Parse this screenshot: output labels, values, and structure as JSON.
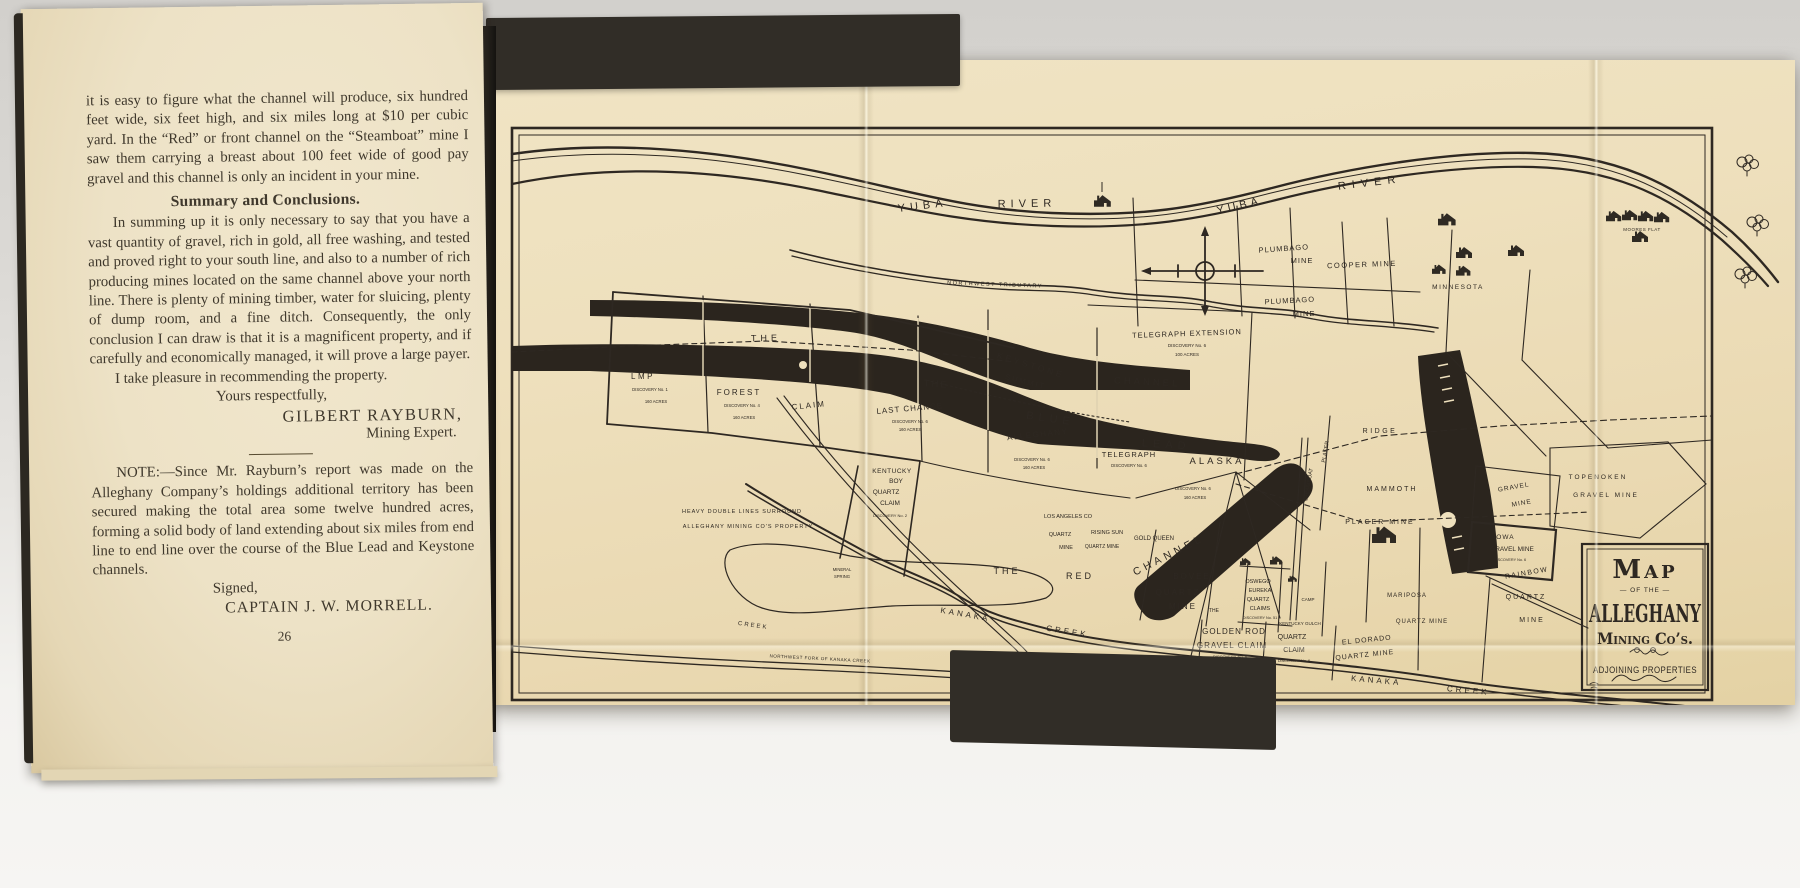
{
  "palette": {
    "backdrop": "#dcdad6",
    "cover": "#312d27",
    "page": "#ede2c6",
    "sheet": "#eee0bd",
    "ink": "#2e2822",
    "ink_light": "#efe4c3"
  },
  "left_page": {
    "body_top": "it is easy to figure what the channel will produce, six hundred feet wide, six feet high, and six miles long at $10 per cubic yard.  In the “Red” or front channel on the “Steamboat” mine I saw them carrying a breast about 100 feet wide of good pay gravel and this channel is only an incident in your mine.",
    "heading": "Summary and Conclusions.",
    "body_summary": "In summing up it is only necessary to say that you have a vast quantity of gravel, rich in gold, all free washing, and tested and proved right to your south line, and also to a number of rich producing mines located on the same channel above your north line. There is plenty of mining timber, water for sluicing, plenty of dump room, and a fine ditch.  Consequently, the only conclusion I can draw is that it is a magnificent property, and if carefully and economically managed, it will prove a large payer.",
    "recommend_line": "I take pleasure in recommending the property.",
    "valediction": "Yours respectfully,",
    "signature_name": "GILBERT RAYBURN,",
    "signature_title": "Mining Expert.",
    "note": "NOTE:—Since Mr. Rayburn’s report was made on the Alleghany Company’s holdings additional territory has been secured making the total area some twelve hundred acres, forming a solid body of land extending about six miles from end line to end line over the course of the Blue Lead and Keystone channels.",
    "signed_label": "Signed,",
    "signed_name": "CAPTAIN J. W. MORRELL.",
    "page_number": "26"
  },
  "map": {
    "ink": "#2e2822",
    "ink_light": "#efe4c3",
    "title_block": {
      "line1": "Map",
      "line2": "— OF THE —",
      "line3": "ALLEGHANY",
      "line4": "Mining Co’s.",
      "line5": "ADJOINING PROPERTIES"
    },
    "labels": [
      {
        "id": "yuba-river-1a",
        "t": "YUBA",
        "x": 433,
        "y": 149,
        "s": 11,
        "r": -7,
        "ls": 5
      },
      {
        "id": "yuba-river-1b",
        "t": "RIVER",
        "x": 537,
        "y": 147,
        "s": 11,
        "r": -1,
        "ls": 5
      },
      {
        "id": "yuba-river-2a",
        "t": "YUBA",
        "x": 750,
        "y": 149,
        "s": 11,
        "r": -13,
        "ls": 4
      },
      {
        "id": "yuba-river-2b",
        "t": "RIVER",
        "x": 880,
        "y": 126,
        "s": 11,
        "r": -7,
        "ls": 6
      },
      {
        "id": "northwest-tributary",
        "t": "NORTHWEST  TRIBUTARY",
        "x": 505,
        "y": 226,
        "s": 5.5,
        "r": 2,
        "ls": 1.5
      },
      {
        "id": "plumbago-mine-1a",
        "t": "PLUMBAGO",
        "x": 794,
        "y": 191,
        "s": 7.5,
        "r": -4,
        "ls": 1
      },
      {
        "id": "plumbago-mine-1b",
        "t": "MINE",
        "x": 812,
        "y": 203,
        "s": 7.5,
        "ls": 1
      },
      {
        "id": "cooper-mine",
        "t": "COOPER  MINE",
        "x": 872,
        "y": 207,
        "s": 7.5,
        "r": -2,
        "ls": 1.5
      },
      {
        "id": "plumbago-mine-2a",
        "t": "PLUMBAGO",
        "x": 800,
        "y": 243,
        "s": 7.5,
        "r": -3,
        "ls": 1
      },
      {
        "id": "plumbago-mine-2b",
        "t": "MINE",
        "x": 814,
        "y": 256,
        "s": 7.5,
        "ls": 1
      },
      {
        "id": "minnesota",
        "t": "MINNESOTA",
        "x": 968,
        "y": 229,
        "s": 6.5,
        "ls": 1.5
      },
      {
        "id": "moores-flat",
        "t": "MOORES FLAT",
        "x": 1152,
        "y": 171,
        "s": 4.5,
        "ls": 0.5
      },
      {
        "id": "telegraph-extension",
        "t": "TELEGRAPH EXTENSION",
        "x": 697,
        "y": 276,
        "s": 7.5,
        "r": -2,
        "ls": 1
      },
      {
        "id": "telegraph-extension-disc",
        "t": "DISCOVERY No. 6",
        "x": 697,
        "y": 287,
        "s": 4.5
      },
      {
        "id": "telegraph-extension-acres",
        "t": "100 ACRES",
        "x": 697,
        "y": 296,
        "s": 4.5
      },
      {
        "id": "the-dashed",
        "t": "THE",
        "x": 276,
        "y": 281,
        "s": 9,
        "r": -1,
        "ls": 4
      },
      {
        "id": "keystone",
        "t": "KEYSTONE",
        "x": 540,
        "y": 308,
        "s": 8.5,
        "r": 17,
        "ls": 3,
        "w": 1
      },
      {
        "id": "summit",
        "t": "SUMMIT",
        "x": 535,
        "y": 324,
        "s": 7.5,
        "r": 14,
        "ls": 2,
        "w": 1
      },
      {
        "id": "channel-keystone",
        "t": "CHANNEL",
        "x": 657,
        "y": 325,
        "s": 9.5,
        "r": 3,
        "ls": 3,
        "w": 1
      },
      {
        "id": "the-blue",
        "t": "THE",
        "x": 446,
        "y": 327,
        "s": 9.5,
        "r": 4,
        "ls": 2,
        "w": 1
      },
      {
        "id": "blue",
        "t": "BLUE",
        "x": 560,
        "y": 362,
        "s": 11,
        "r": 8,
        "ls": 5,
        "w": 1
      },
      {
        "id": "lead",
        "t": "LEAD",
        "x": 676,
        "y": 388,
        "s": 11,
        "r": 4,
        "ls": 5,
        "w": 1
      },
      {
        "id": "last-chance",
        "t": "LAST  CHANCE",
        "x": 420,
        "y": 351,
        "s": 8,
        "r": -5,
        "ls": 1
      },
      {
        "id": "last-chance-disc",
        "t": "DISCOVERY No. 6",
        "x": 420,
        "y": 363,
        "s": 4.2
      },
      {
        "id": "last-chance-acres",
        "t": "160 ACRES",
        "x": 420,
        "y": 371,
        "s": 4.2
      },
      {
        "id": "alleghany-claim",
        "t": "ALLEGHANY",
        "x": 548,
        "y": 377,
        "s": 8,
        "r": -6,
        "ls": 1.5
      },
      {
        "id": "alleghany-disc",
        "t": "DISCOVERY No. 6",
        "x": 542,
        "y": 401,
        "s": 4.2
      },
      {
        "id": "alleghany-acres",
        "t": "160 ACRES",
        "x": 544,
        "y": 409,
        "s": 4.2
      },
      {
        "id": "telegraph",
        "t": "TELEGRAPH",
        "x": 639,
        "y": 397,
        "s": 7.5,
        "ls": 1
      },
      {
        "id": "telegraph-disc",
        "t": "DISCOVERY No. 6",
        "x": 639,
        "y": 407,
        "s": 4.2
      },
      {
        "id": "alaska",
        "t": "ALASKA",
        "x": 727,
        "y": 404,
        "s": 9.5,
        "ls": 3
      },
      {
        "id": "alaska-disc",
        "t": "DISCOVERY No. 6",
        "x": 703,
        "y": 430,
        "s": 4.2
      },
      {
        "id": "alaska-acres",
        "t": "160 ACRES",
        "x": 705,
        "y": 439,
        "s": 4.2
      },
      {
        "id": "lmp",
        "t": "LMP",
        "x": 153,
        "y": 319,
        "s": 8,
        "ls": 2.5
      },
      {
        "id": "lmp-disc",
        "t": "DISCOVERY No. 1",
        "x": 160,
        "y": 331,
        "s": 4.2
      },
      {
        "id": "lmp-acres",
        "t": "160 ACRES",
        "x": 166,
        "y": 343,
        "s": 4.2
      },
      {
        "id": "forest",
        "t": "FOREST",
        "x": 249,
        "y": 335,
        "s": 8,
        "ls": 2
      },
      {
        "id": "forest-disc",
        "t": "DISCOVERY No. 4",
        "x": 252,
        "y": 347,
        "s": 4.2
      },
      {
        "id": "forest-acres",
        "t": "160 ACRES",
        "x": 254,
        "y": 359,
        "s": 4.2
      },
      {
        "id": "claim",
        "t": "CLAIM",
        "x": 319,
        "y": 348,
        "s": 8,
        "r": -6,
        "ls": 2
      },
      {
        "id": "kentucky-boy-1",
        "t": "KENTUCKY",
        "x": 402,
        "y": 413,
        "s": 6.5,
        "ls": 0.5
      },
      {
        "id": "kentucky-boy-2",
        "t": "BOY",
        "x": 406,
        "y": 423,
        "s": 6.5
      },
      {
        "id": "kentucky-boy-3",
        "t": "QUARTZ",
        "x": 396,
        "y": 434,
        "s": 6.5
      },
      {
        "id": "kentucky-boy-4",
        "t": "CLAIM",
        "x": 400,
        "y": 445,
        "s": 6.5
      },
      {
        "id": "kentucky-boy-disc",
        "t": "DISCOVERY No. 2",
        "x": 400,
        "y": 457,
        "s": 4
      },
      {
        "id": "legend-line-1",
        "t": "HEAVY DOUBLE LINES SURROUND",
        "x": 252,
        "y": 453,
        "s": 5.5,
        "ls": 1
      },
      {
        "id": "legend-line-2",
        "t": "ALLEGHANY MINING CO'S PROPERTY",
        "x": 258,
        "y": 468,
        "s": 5.5,
        "ls": 1
      },
      {
        "id": "mineral-spring-1",
        "t": "MINERAL",
        "x": 352,
        "y": 511,
        "s": 4.2
      },
      {
        "id": "mineral-spring-2",
        "t": "SPRING",
        "x": 352,
        "y": 518,
        "s": 4.2
      },
      {
        "id": "the-red-1",
        "t": "THE",
        "x": 517,
        "y": 514,
        "s": 9,
        "ls": 3
      },
      {
        "id": "the-red-2",
        "t": "RED",
        "x": 590,
        "y": 519,
        "s": 9,
        "ls": 3
      },
      {
        "id": "los-angeles",
        "t": "LOS ANGELES CO",
        "x": 578,
        "y": 458,
        "s": 5.5
      },
      {
        "id": "los-angeles-2",
        "t": "QUARTZ",
        "x": 570,
        "y": 476,
        "s": 5.5
      },
      {
        "id": "los-angeles-3",
        "t": "MINE",
        "x": 576,
        "y": 489,
        "s": 5.5
      },
      {
        "id": "rising-sun",
        "t": "RISING SUN",
        "x": 617,
        "y": 474,
        "s": 5.5
      },
      {
        "id": "rising-sun-2",
        "t": "QUARTZ MINE",
        "x": 612,
        "y": 488,
        "s": 5
      },
      {
        "id": "gold-queen",
        "t": "GOLD QUEEN",
        "x": 664,
        "y": 480,
        "s": 6
      },
      {
        "id": "channel-red",
        "t": "CHANNEL",
        "x": 680,
        "y": 498,
        "s": 10.5,
        "r": -27,
        "ls": 4,
        "w": 1
      },
      {
        "id": "bovee",
        "t": "BOVEE",
        "x": 702,
        "y": 519,
        "s": 8,
        "ls": 2
      },
      {
        "id": "bovee-2",
        "t": "QUARTZ",
        "x": 688,
        "y": 535,
        "s": 8,
        "ls": 2
      },
      {
        "id": "bovee-3",
        "t": "MINE",
        "x": 693,
        "y": 549,
        "s": 8,
        "ls": 2
      },
      {
        "id": "the-small",
        "t": "THE",
        "x": 724,
        "y": 552,
        "s": 5
      },
      {
        "id": "oswego-1",
        "t": "OSWEGO",
        "x": 768,
        "y": 523,
        "s": 5.5
      },
      {
        "id": "oswego-2",
        "t": "EUREKA",
        "x": 770,
        "y": 532,
        "s": 5.5
      },
      {
        "id": "oswego-3",
        "t": "QUARTZ",
        "x": 768,
        "y": 541,
        "s": 5.5
      },
      {
        "id": "oswego-4",
        "t": "CLAIMS",
        "x": 770,
        "y": 550,
        "s": 5.5
      },
      {
        "id": "oswego-disc",
        "t": "DISCOVERY No. 51",
        "x": 770,
        "y": 559,
        "s": 3.8
      },
      {
        "id": "camp",
        "t": "CAMP",
        "x": 818,
        "y": 541,
        "s": 4.5
      },
      {
        "id": "kentucky-gulch",
        "t": "KENTUCKY GULCH",
        "x": 810,
        "y": 565,
        "s": 4.5
      },
      {
        "id": "golden-rod-1",
        "t": "GOLDEN  ROD",
        "x": 744,
        "y": 574,
        "s": 8,
        "ls": 1
      },
      {
        "id": "golden-rod-2",
        "t": "GRAVEL CLAIM",
        "x": 742,
        "y": 588,
        "s": 8,
        "ls": 1
      },
      {
        "id": "golden-rod-disc",
        "t": "DISCOVERY No. 6",
        "x": 740,
        "y": 598,
        "s": 4
      },
      {
        "id": "golden-rod-acres",
        "t": "160 ACRES",
        "x": 730,
        "y": 606,
        "s": 4
      },
      {
        "id": "quartz-claim-1",
        "t": "QUARTZ",
        "x": 802,
        "y": 579,
        "s": 7
      },
      {
        "id": "quartz-claim-2",
        "t": "CLAIM",
        "x": 804,
        "y": 592,
        "s": 7
      },
      {
        "id": "quartz-claim-disc",
        "t": "DISCOVERY No. 6",
        "x": 804,
        "y": 602,
        "s": 3.8
      },
      {
        "id": "el-dorado-1",
        "t": "EL DORADO",
        "x": 877,
        "y": 582,
        "s": 7,
        "r": -6,
        "ls": 1
      },
      {
        "id": "el-dorado-2",
        "t": "QUARTZ  MINE",
        "x": 875,
        "y": 597,
        "s": 7,
        "r": -6,
        "ls": 1
      },
      {
        "id": "kanaka-1",
        "t": "KANAKA",
        "x": 475,
        "y": 557,
        "s": 8,
        "r": 10,
        "ls": 3
      },
      {
        "id": "creek-0",
        "t": "CREEK",
        "x": 263,
        "y": 567,
        "s": 6,
        "r": 8,
        "ls": 2
      },
      {
        "id": "creek-1",
        "t": "CREEK",
        "x": 577,
        "y": 574,
        "s": 8,
        "r": 9,
        "ls": 3
      },
      {
        "id": "kanaka-2",
        "t": "KANAKA",
        "x": 886,
        "y": 623,
        "s": 8,
        "r": 5,
        "ls": 3
      },
      {
        "id": "creek-2",
        "t": "CREEK",
        "x": 978,
        "y": 633,
        "s": 8,
        "r": 5,
        "ls": 3
      },
      {
        "id": "nw-fork",
        "t": "NORTHWEST FORK OF KANAKA CREEK",
        "x": 330,
        "y": 600,
        "s": 4.5,
        "r": 3,
        "ls": 0.5
      },
      {
        "id": "ridge",
        "t": "RIDGE",
        "x": 890,
        "y": 373,
        "s": 7,
        "ls": 2.5
      },
      {
        "id": "mammoth",
        "t": "MAMMOTH",
        "x": 902,
        "y": 431,
        "s": 7,
        "ls": 2
      },
      {
        "id": "placer-mine",
        "t": "PLACER MINE",
        "x": 890,
        "y": 464,
        "s": 7,
        "ls": 2
      },
      {
        "id": "steamboat",
        "t": "STEAMBOAT",
        "x": 820,
        "y": 425,
        "s": 5.5,
        "r": -80
      },
      {
        "id": "placer-vertical",
        "t": "PLACER",
        "x": 837,
        "y": 392,
        "s": 5.5,
        "r": -80
      },
      {
        "id": "mariposa",
        "t": "MARIPOSA",
        "x": 917,
        "y": 537,
        "s": 6,
        "ls": 1
      },
      {
        "id": "quartz-mine-sw",
        "t": "QUARTZ MINE",
        "x": 932,
        "y": 563,
        "s": 6,
        "ls": 1
      },
      {
        "id": "gravel-mine-1",
        "t": "GRAVEL",
        "x": 1024,
        "y": 429,
        "s": 6.5,
        "r": -10,
        "ls": 1
      },
      {
        "id": "gravel-mine-2",
        "t": "MINE",
        "x": 1032,
        "y": 445,
        "s": 6.5,
        "r": -10,
        "ls": 1
      },
      {
        "id": "iowa-1",
        "t": "IOWA",
        "x": 1014,
        "y": 479,
        "s": 6.5,
        "ls": 1
      },
      {
        "id": "iowa-2",
        "t": "GRAVEL MINE",
        "x": 1022,
        "y": 491,
        "s": 6.5
      },
      {
        "id": "iowa-disc",
        "t": "DISCOVERY No. 6",
        "x": 1020,
        "y": 501,
        "s": 3.8
      },
      {
        "id": "rainbow",
        "t": "RAINBOW",
        "x": 1037,
        "y": 515,
        "s": 7,
        "r": -10,
        "ls": 1.5
      },
      {
        "id": "quartz-se",
        "t": "QUARTZ",
        "x": 1036,
        "y": 539,
        "s": 7,
        "ls": 2
      },
      {
        "id": "mine-se",
        "t": "MINE",
        "x": 1042,
        "y": 562,
        "s": 7,
        "ls": 2
      },
      {
        "id": "topenoken-1",
        "t": "TOPENOKEN",
        "x": 1108,
        "y": 419,
        "s": 6.5,
        "ls": 2
      },
      {
        "id": "topenoken-2",
        "t": "GRAVEL MINE",
        "x": 1116,
        "y": 437,
        "s": 6.5,
        "ls": 2
      }
    ]
  }
}
